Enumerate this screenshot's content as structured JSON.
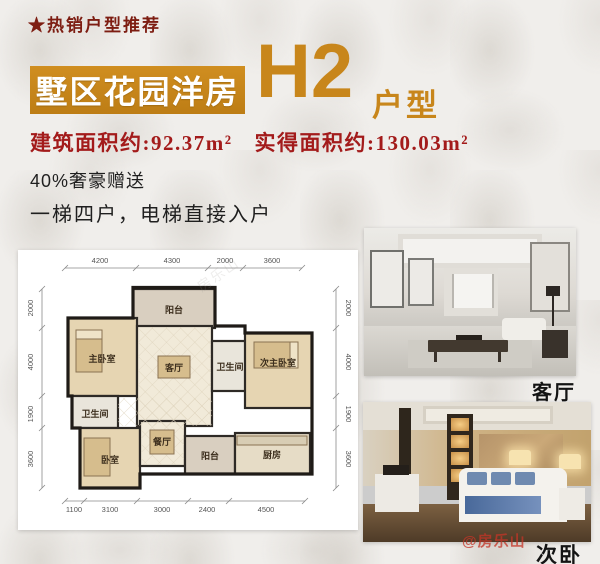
{
  "header": {
    "tagline": "★热销户型推荐",
    "banner_title": "墅区花园洋房",
    "unit_code": "H2",
    "unit_suffix": "户型",
    "built_area": "建筑面积约:92.37m²",
    "actual_area": "实得面积约:130.03m²",
    "bonus": "40%奢豪赠送",
    "feature": "一梯四户，电梯直接入户"
  },
  "floorplan": {
    "dims_top": [
      "4200",
      "4300",
      "2000",
      "3600"
    ],
    "dims_left": [
      "2000",
      "4000",
      "1900",
      "3600"
    ],
    "dims_right": [
      "2000",
      "4000",
      "1900",
      "3600"
    ],
    "dims_bottom": [
      "1100",
      "3100",
      "3000",
      "2400",
      "4500"
    ],
    "rooms": {
      "balcony_top": "阳台",
      "master_bedroom": "主卧室",
      "living_room": "客厅",
      "bathroom_mid": "卫生间",
      "second_master": "次主卧室",
      "bathroom_left": "卫生间",
      "bedroom": "卧室",
      "dining_room": "餐厅",
      "balcony_bottom": "阳台",
      "kitchen": "厨房"
    }
  },
  "photos": {
    "living_caption": "客厅",
    "bedroom_caption": "次卧"
  },
  "watermark": {
    "handle": "@房乐山"
  },
  "colors": {
    "gold": "#c8861b",
    "title_red": "#7d1d12",
    "area_red": "#a31b1b"
  }
}
